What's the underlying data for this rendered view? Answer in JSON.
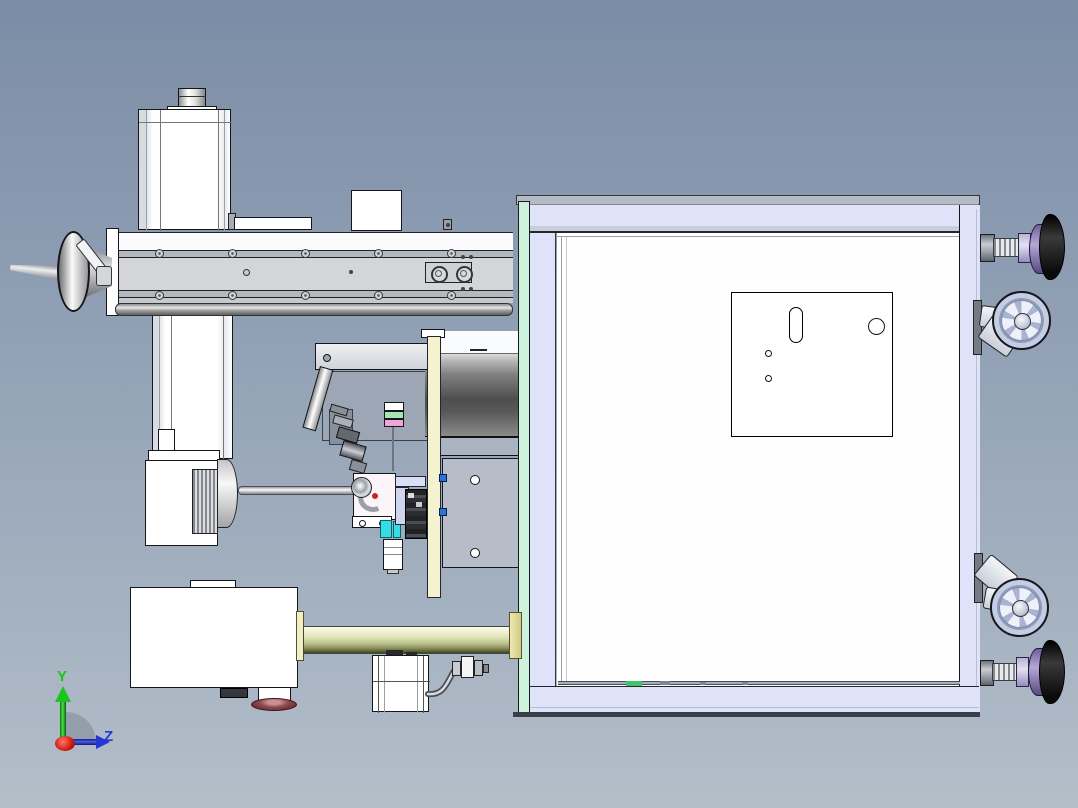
{
  "viewport": {
    "kind": "3D CAD assembly viewport, machine shown lying on its side",
    "visible_text": [
      "Y",
      "Z"
    ]
  },
  "triad": {
    "y_label": "Y",
    "z_label": "Z",
    "x_axis": "toward viewer (red origin blob)"
  },
  "palette": {
    "background_top": "#7b8da6",
    "background_bottom": "#b3bec9",
    "cabinet_lavender": "#dfe3f9",
    "cabinet_mint": "#ccf2dc",
    "column_yellow": "#f5f3cf",
    "accent_cyan": "#36dce6",
    "accent_pink": "#f0a6d8",
    "accent_green": "#a6e6b6",
    "clip_blue": "#2b6fe0",
    "wheel_blue": "#c8d2e8",
    "foot_dome_purple": "#8f7fbc",
    "foot_pad_black": "#141414",
    "pad_red": "#8c4a50",
    "status_green": "#3fc468",
    "axis_y_green": "#1ec41e",
    "axis_z_blue": "#2636d4",
    "origin_red": "#cc2222"
  }
}
